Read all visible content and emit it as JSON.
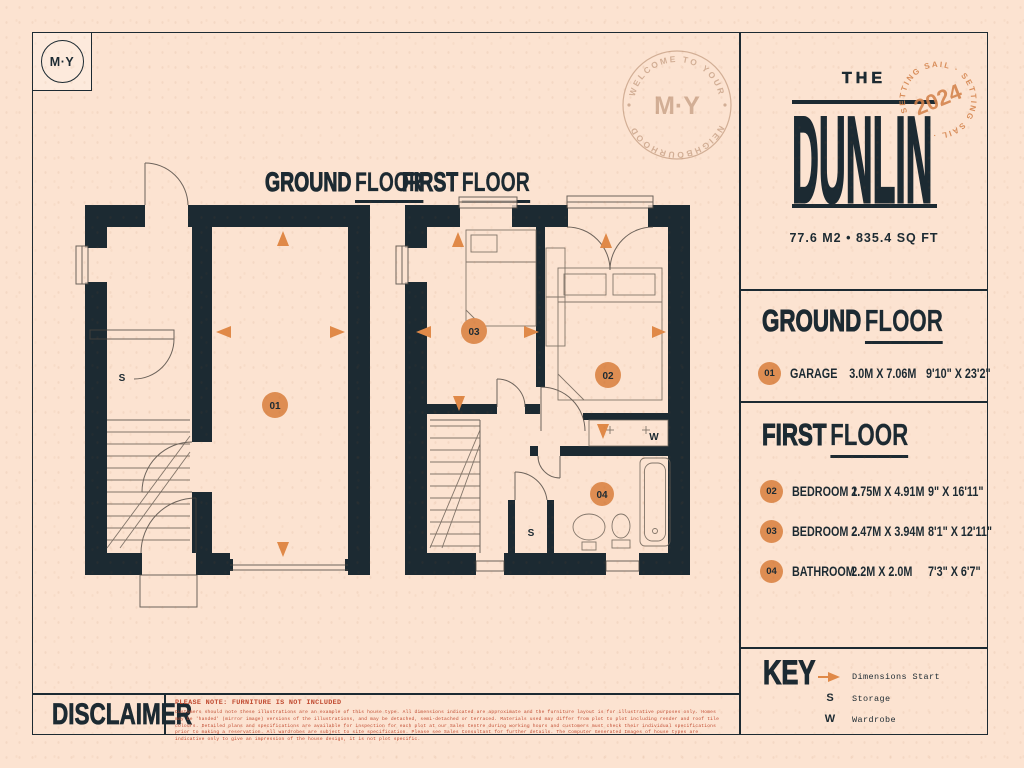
{
  "colors": {
    "background": "#fce3d1",
    "ink_navy": "#1c2a32",
    "accent_orange": "#de8d52",
    "stamp_tan": "#c8a287",
    "warning_red": "#c04a30"
  },
  "logo": {
    "text": "M·Y"
  },
  "welcome_stamp": {
    "arc_top": "WELCOME TO YOUR",
    "arc_bottom": "NEIGHBOURHOOD",
    "center": "M·Y"
  },
  "title_panel": {
    "prefix": "THE",
    "name": "DUNLIN",
    "area": "77.6 M2  •  835.4 SQ FT",
    "stamp": {
      "year": "2024",
      "arc_text": "SETTING SAIL · SETTING SAIL ·"
    }
  },
  "floor_plans": {
    "ground": {
      "title_word1": "GROUND",
      "title_word2": "FLOOR",
      "badge": "01",
      "storage_label": "S"
    },
    "first": {
      "title_word1": "FIRST",
      "title_word2": "FLOOR",
      "badges": {
        "bedroom1": "02",
        "bedroom2": "03",
        "bathroom": "04"
      },
      "storage_label": "S",
      "wardrobe_label": "W"
    }
  },
  "ground_floor_panel": {
    "title_word1": "GROUND",
    "title_word2": "FLOOR",
    "rooms": [
      {
        "num": "01",
        "name": "GARAGE",
        "metric": "3.0M X 7.06M",
        "imperial": "9'10\" X 23'2\""
      }
    ]
  },
  "first_floor_panel": {
    "title_word1": "FIRST",
    "title_word2": "FLOOR",
    "rooms": [
      {
        "num": "02",
        "name": "BEDROOM 1",
        "metric": "2.75M X 4.91M",
        "imperial": "9\" X 16'11\""
      },
      {
        "num": "03",
        "name": "BEDROOM 2",
        "metric": "2.47M X 3.94M",
        "imperial": "8'1\" X 12'11\""
      },
      {
        "num": "04",
        "name": "BATHROOM",
        "metric": "2.2M X 2.0M",
        "imperial": "7'3\" X 6'7\""
      }
    ]
  },
  "key_panel": {
    "title": "KEY",
    "items": [
      {
        "symbol": "dimension-arrow",
        "label": "Dimensions Start"
      },
      {
        "symbol": "S",
        "label": "Storage"
      },
      {
        "symbol": "W",
        "label": "Wardrobe"
      }
    ]
  },
  "disclaimer_panel": {
    "title": "DISCLAIMER",
    "note": "PLEASE NOTE: FURNITURE IS NOT INCLUDED",
    "body": "Customers should note these illustrations are an example of this house type. All dimensions indicated are approximate and the furniture layout is for illustrative purposes only. Homes may be 'handed' (mirror image) versions of the illustrations, and may be detached, semi-detached or terraced. Materials used may differ from plot to plot including render and roof tile colours. Detailed plans and specifications are available for inspection for each plot at our Sales Centre during working hours and customers must check their individual specifications prior to making a reservation. All wardrobes are subject to site specification. Please see Sales Consultant for further details. The Computer Generated Images of house types are indicative only to give an impression of the house design, it is not plot specific."
  }
}
